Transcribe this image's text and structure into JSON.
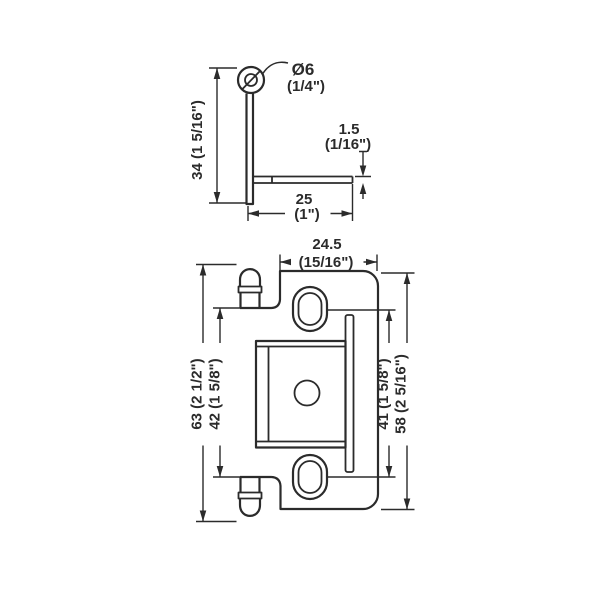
{
  "colors": {
    "line": "#2b2b2b",
    "background": "#ffffff"
  },
  "side_view": {
    "pin_diameter": {
      "metric": "Ø6",
      "imperial": "(1/4\")"
    },
    "height": "34 (1 5/16\")",
    "plate_thickness": {
      "metric": "1.5",
      "imperial": "(1/16\")"
    },
    "depth": {
      "metric": "25",
      "imperial": "(1\")"
    }
  },
  "front_view": {
    "wing_width": {
      "metric": "24.5",
      "imperial": "(15/16\")"
    },
    "overall_height": "63 (2 1/2\")",
    "knuckle_inner_height": "42 (1 5/8\")",
    "slot_center_distance": "41 (1 5/8\")",
    "plate_height": "58 (2 5/16\")"
  }
}
